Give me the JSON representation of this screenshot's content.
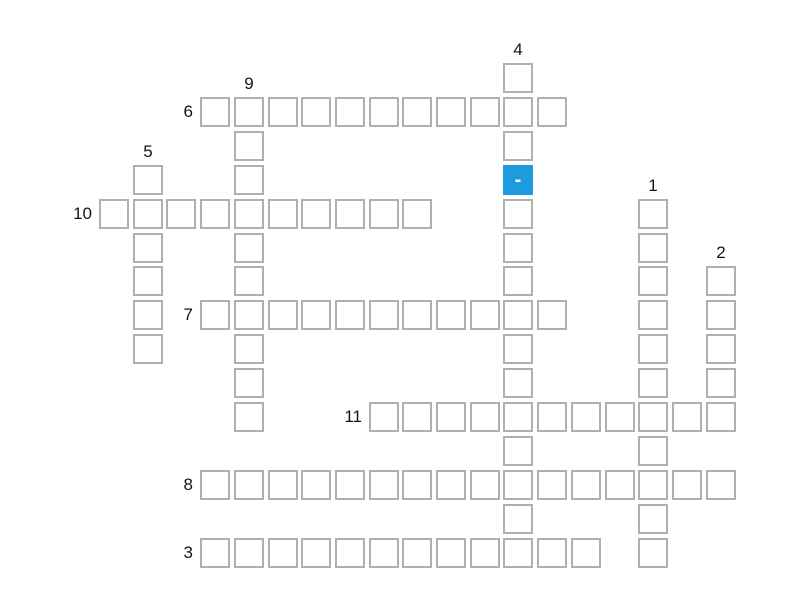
{
  "page": {
    "background_color": "#ffffff"
  },
  "grid": {
    "origin_x": 99,
    "origin_y": 63,
    "pitch_x": 33.7,
    "pitch_y": 33.9,
    "cell_outer_size": 30,
    "cell_border_color": "#b0b0b0",
    "cell_fill_color": "#ffffff",
    "number_color": "#141414"
  },
  "words": [
    {
      "number": "1",
      "direction": "down",
      "col": 16,
      "row": 4,
      "length": 11
    },
    {
      "number": "2",
      "direction": "down",
      "col": 18,
      "row": 6,
      "length": 5
    },
    {
      "number": "3",
      "direction": "across",
      "col": 3,
      "row": 14,
      "length": 12
    },
    {
      "number": "4",
      "direction": "down",
      "col": 12,
      "row": 0,
      "length": 15
    },
    {
      "number": "5",
      "direction": "down",
      "col": 1,
      "row": 3,
      "length": 6
    },
    {
      "number": "6",
      "direction": "across",
      "col": 3,
      "row": 1,
      "length": 11
    },
    {
      "number": "7",
      "direction": "across",
      "col": 3,
      "row": 7,
      "length": 11
    },
    {
      "number": "8",
      "direction": "across",
      "col": 3,
      "row": 12,
      "length": 16
    },
    {
      "number": "9",
      "direction": "down",
      "col": 4,
      "row": 1,
      "length": 10
    },
    {
      "number": "10",
      "direction": "across",
      "col": 0,
      "row": 4,
      "length": 10
    },
    {
      "number": "11",
      "direction": "across",
      "col": 8,
      "row": 10,
      "length": 11
    }
  ],
  "active_cell": {
    "col": 12,
    "row": 3,
    "text": "-",
    "fill_color": "#1e9bdf",
    "text_color": "#ffffff"
  }
}
